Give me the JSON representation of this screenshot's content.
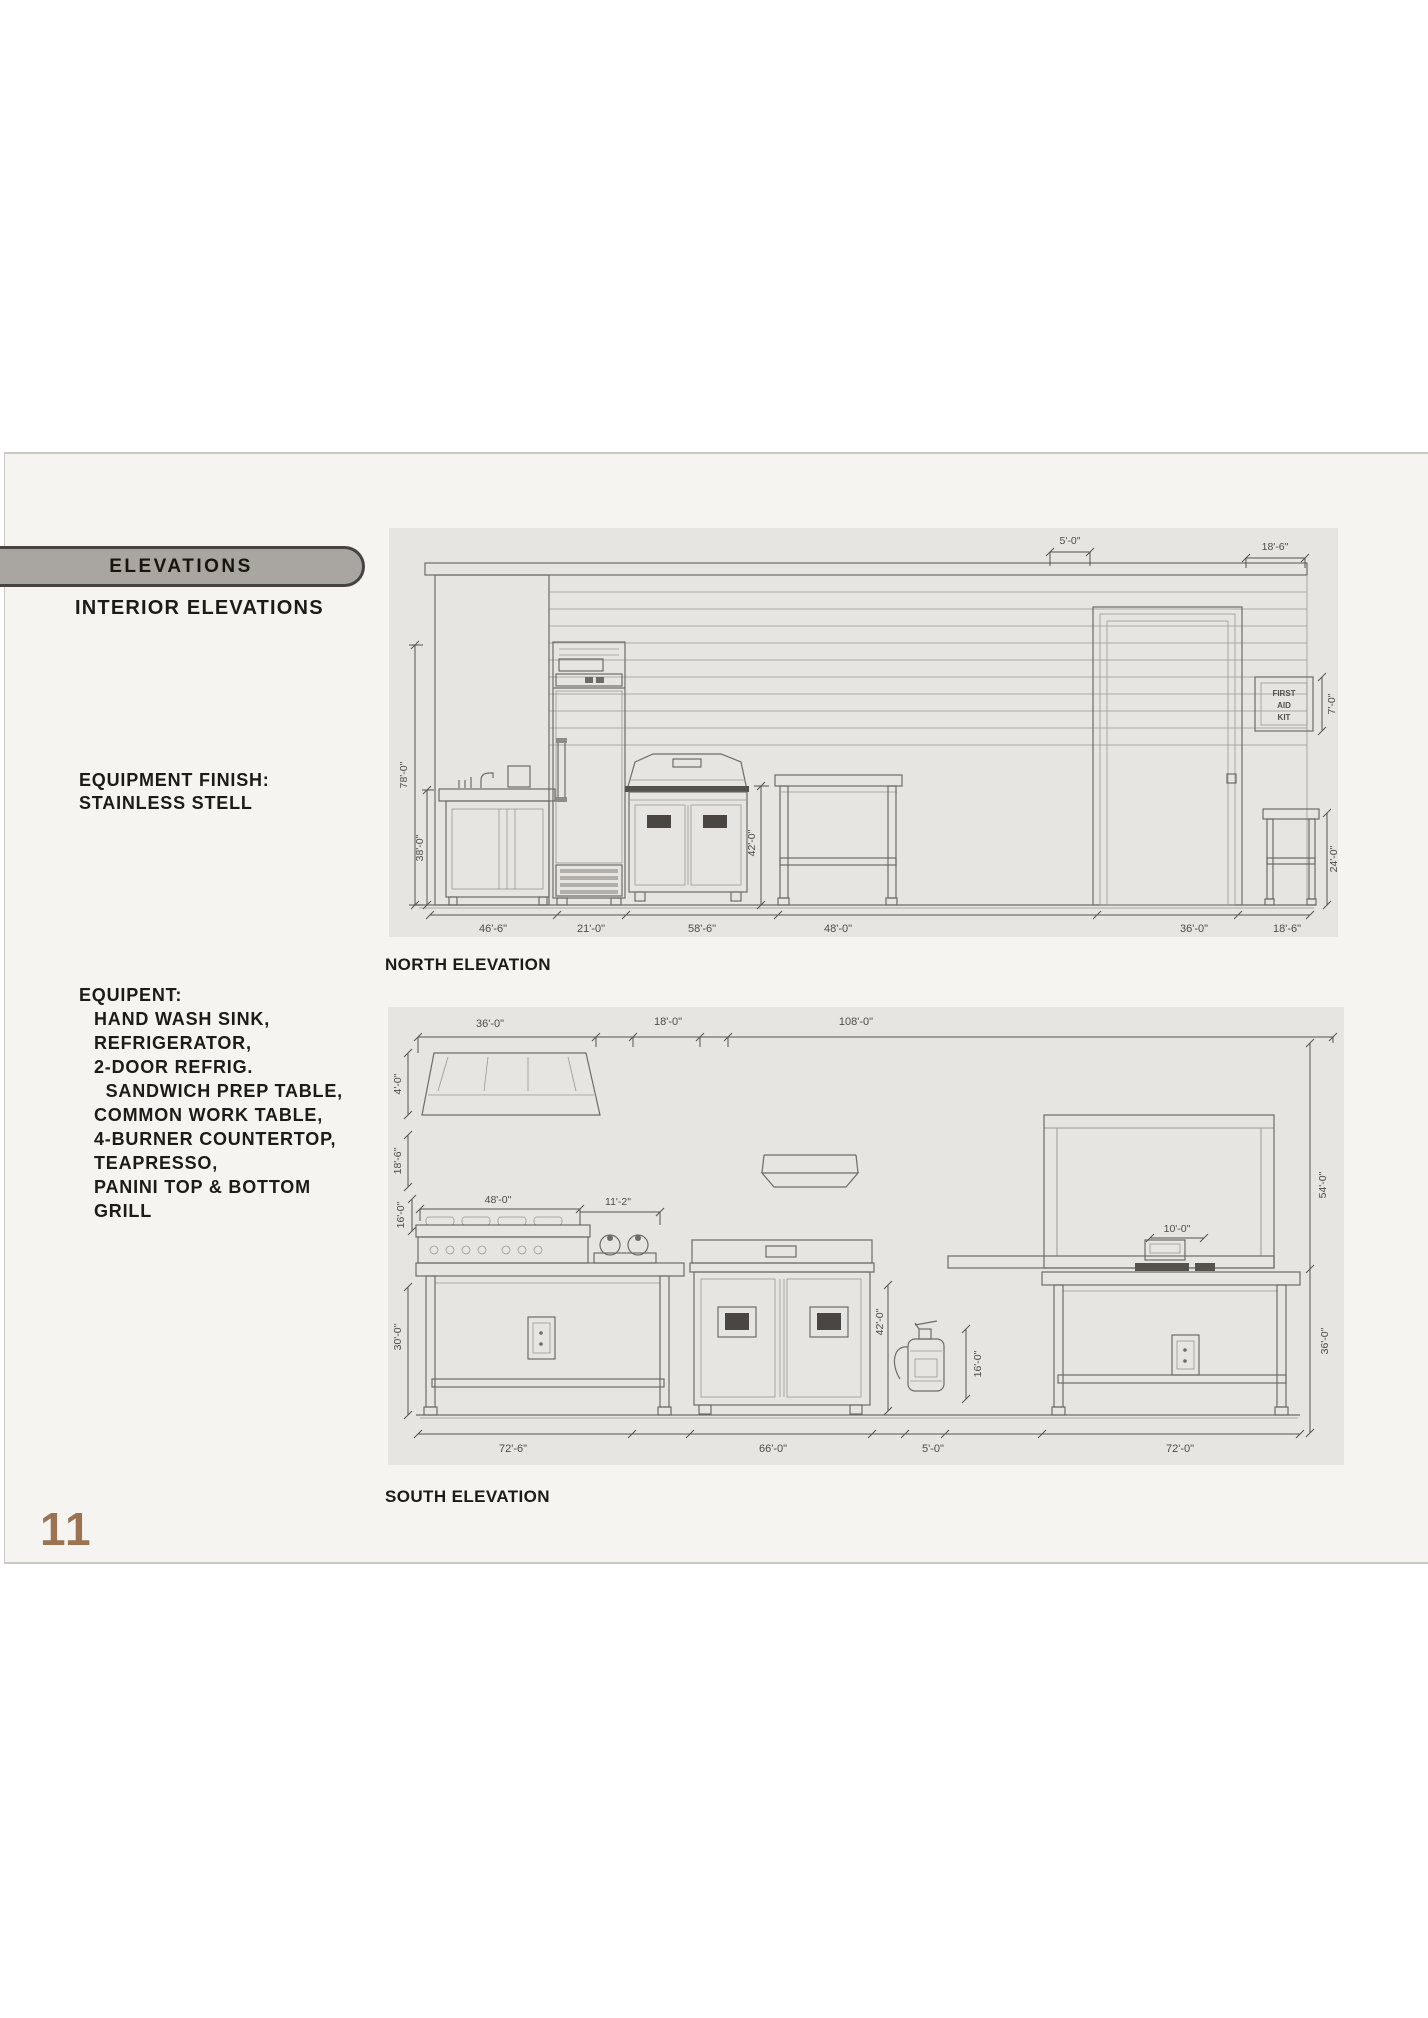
{
  "page": {
    "number": "11",
    "background": "#ffffff",
    "content_background": "#f5f4f1",
    "drawing_background": "#e7e5e2",
    "accent_brown": "#9b7352",
    "tab_fill": "#a9a5a1"
  },
  "header": {
    "tab_label": "ELEVATIONS",
    "subtitle": "INTERIOR ELEVATIONS"
  },
  "equipment_finish": {
    "line1": "EQUIPMENT FINISH:",
    "line2": "STAINLESS STELL"
  },
  "equipment_list": {
    "title": "EQUIPENT:",
    "items": [
      "HAND WASH SINK,",
      "REFRIGERATOR,",
      "2-DOOR REFRIG.",
      "  SANDWICH PREP TABLE,",
      "COMMON WORK TABLE,",
      "4-BURNER COUNTERTOP,",
      "TEAPRESSO,",
      "PANINI TOP & BOTTOM",
      "GRILL"
    ]
  },
  "north_elevation": {
    "label": "NORTH ELEVATION",
    "first_aid_sign": [
      "FIRST",
      "AID",
      "KIT"
    ],
    "dims": {
      "overall_height": "78'-0\"",
      "counter_height": "38'-0\"",
      "top_left": "5'-0\"",
      "top_right": "18'-6\"",
      "prep_table_height": "42'-0\"",
      "first_aid_height": "7'-0\"",
      "stool_height": "24'-0\"",
      "bottom": [
        "46'-6\"",
        "21'-0\"",
        "58'-6\"",
        "48'-0\"",
        "36'-0\"",
        "18'-6\""
      ]
    }
  },
  "south_elevation": {
    "label": "SOUTH ELEVATION",
    "dims": {
      "top": [
        "36'-0\"",
        "18'-0\"",
        "108'-0\""
      ],
      "hood_height": "4'-0\"",
      "left": [
        "18'-6\"",
        "16'-0\"",
        "30'-0\""
      ],
      "range_width": "48'-0\"",
      "teapresso_width": "11'-2\"",
      "cabinet_height": "42'-0\"",
      "extinguisher_height": "16'-0\"",
      "register_width": "10'-0\"",
      "right": [
        "54'-0\"",
        "36'-0\""
      ],
      "bottom": [
        "72'-6\"",
        "66'-0\"",
        "5'-0\"",
        "72'-0\""
      ]
    }
  }
}
